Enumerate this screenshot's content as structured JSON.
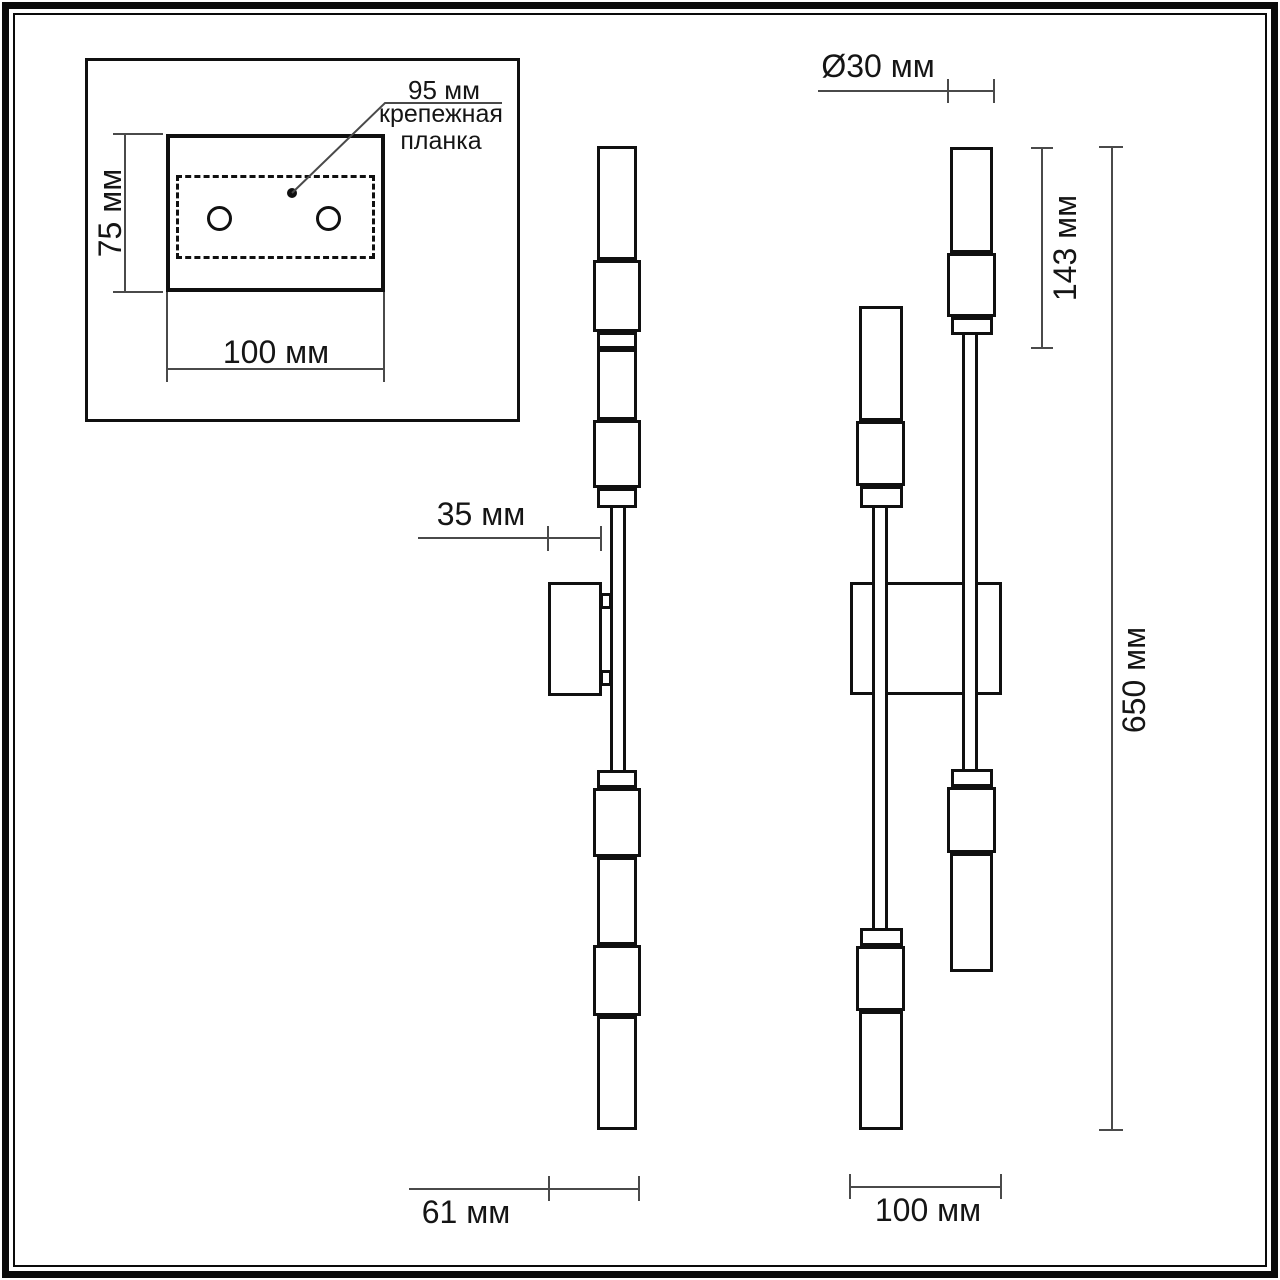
{
  "inset": {
    "leader_label": "95 мм",
    "plate_label_line1": "крепежная",
    "plate_label_line2": "планка",
    "dim_height": "75 мм",
    "dim_width": "100 мм"
  },
  "side_view": {
    "dim_offset": "35 мм",
    "dim_depth": "61 мм"
  },
  "front_view": {
    "dim_diameter": "Ø30 мм",
    "dim_lamp_length": "143 мм",
    "dim_total_height": "650 мм",
    "dim_width": "100 мм"
  },
  "colors": {
    "drawing_line": "#101010",
    "dimension_line": "#4a4a4a",
    "text": "#151515",
    "background": "#ffffff"
  }
}
